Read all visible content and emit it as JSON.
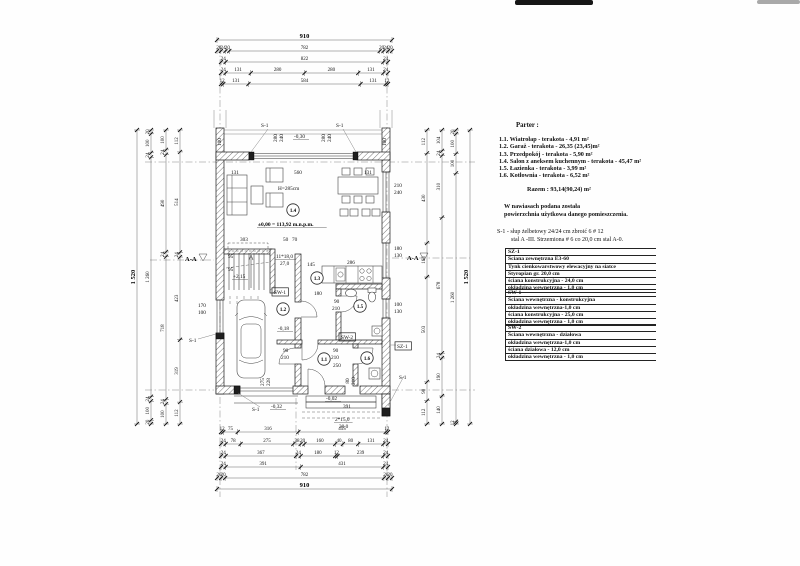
{
  "legend": {
    "title": "Parter :",
    "rooms": [
      "1.1.  Wiatrołap - terakota - 4,91 m²",
      "1.2.  Garaż - terakota - 26,35 (23,45)m²",
      "1.3.  Przedpokój - terakota - 5,90 m²",
      "1.4.  Salon z aneksem kuchennym - terakota - 45,47 m²",
      "1.5.  Łazienka - terakota - 3,99 m²",
      "1.6.  Kotłownia - terakota - 6,52 m²"
    ],
    "total": "Razem : 93,14(90,24)  m²",
    "note1": "W nawiasach podana została",
    "note2": "powierzchnia użytkowa danego pomieszczenia.",
    "s1_note1": "S-1 -  słup żelbetowy 24/24 cm zbroić 6 # 12",
    "s1_note2": "stal A -III. Strzemiona # 6 co 20,0 cm stal A-0.",
    "sz1": {
      "rows": [
        "SZ-1",
        "Ściana zewnętrzna E3-60",
        "Tynk cienkowarstwowy elewacyjny na siatce",
        "Styropian gr. 20,0 cm",
        "ściana konstrukcyjna - 24,0 cm",
        "okładzina wewnętrzna - 1,0 cm"
      ]
    },
    "sw1": {
      "rows": [
        "SW-1",
        "Ściana wewnętrzna - konstrukcyjna",
        "okładzina wewnętrzna-1,0 cm",
        "ściana konstrukcyjna - 25,0 cm",
        "okładzina wewnętrzna - 1,0 cm"
      ]
    },
    "sw2": {
      "rows": [
        "SW-2",
        "Ściana wewnętrzna - działowa",
        "okładzina wewnętrzna-1,0 cm",
        "ściana działowa - 12,0 cm",
        "okładzina wewnętrzna - 1,0 cm"
      ]
    }
  },
  "rooms": [
    {
      "id": "1.1",
      "x": 324,
      "y": 359
    },
    {
      "id": "1.2",
      "x": 283,
      "y": 309
    },
    {
      "id": "1.3",
      "x": 317,
      "y": 278
    },
    {
      "id": "1.4",
      "x": 293,
      "y": 210
    },
    {
      "id": "1.5",
      "x": 360,
      "y": 306
    },
    {
      "id": "1.6",
      "x": 367,
      "y": 358
    }
  ],
  "chains": [
    {
      "dir": "h",
      "y": 40,
      "x0": 217,
      "x1": 392,
      "v": [
        "910"
      ],
      "big": true
    },
    {
      "dir": "h",
      "y": 51,
      "x0": 217,
      "x1": 392,
      "v": [
        20,
        24,
        20,
        782,
        20,
        24,
        20
      ]
    },
    {
      "dir": "h",
      "y": 62,
      "x0": 221,
      "x1": 388,
      "v": [
        24,
        822,
        24
      ]
    },
    {
      "dir": "h",
      "y": 73,
      "x0": 221,
      "x1": 388,
      "v": [
        24,
        131,
        280,
        280,
        131,
        24
      ]
    },
    {
      "dir": "h",
      "y": 84,
      "x0": 221,
      "x1": 388,
      "v": [
        12,
        131,
        584,
        131,
        12
      ]
    },
    {
      "dir": "h",
      "y": 432,
      "x0": 221,
      "x1": 388,
      "v": [
        12,
        75,
        316,
        455,
        12
      ]
    },
    {
      "dir": "h",
      "y": 444,
      "x0": 221,
      "x1": 388,
      "v": [
        24,
        78,
        275,
        38,
        20,
        160,
        40,
        80,
        131,
        24
      ]
    },
    {
      "dir": "h",
      "y": 456,
      "x0": 221,
      "x1": 388,
      "v": [
        24,
        367,
        24,
        180,
        12,
        239,
        24
      ]
    },
    {
      "dir": "h",
      "y": 467,
      "x0": 221,
      "x1": 388,
      "v": [
        24,
        391,
        431,
        24
      ]
    },
    {
      "dir": "h",
      "y": 478,
      "x0": 217,
      "x1": 392,
      "v": [
        20,
        20,
        782,
        20,
        20
      ]
    },
    {
      "dir": "h",
      "y": 489,
      "x0": 217,
      "x1": 392,
      "v": [
        "910"
      ],
      "big": true
    },
    {
      "dir": "v",
      "x": 137,
      "y0": 130,
      "y1": 424,
      "v": [
        "1 520"
      ],
      "big": true
    },
    {
      "dir": "v",
      "x": 151,
      "y0": 130,
      "y1": 424,
      "v": [
        20,
        100,
        24,
        "1 260",
        24,
        100,
        20
      ]
    },
    {
      "dir": "v",
      "x": 166,
      "y0": 130,
      "y1": 424,
      "v": [
        100,
        24,
        490,
        24,
        718,
        24,
        100
      ]
    },
    {
      "dir": "v",
      "x": 180,
      "y0": 130,
      "y1": 424,
      "v": [
        112,
        514,
        24,
        423,
        319,
        112
      ]
    },
    {
      "dir": "v",
      "x": 427,
      "y0": 130,
      "y1": 424,
      "v": [
        112,
        430,
        163,
        503,
        90,
        112
      ]
    },
    {
      "dir": "v",
      "x": 442,
      "y0": 130,
      "y1": 424,
      "v": [
        104,
        24,
        310,
        678,
        24,
        190,
        140
      ]
    },
    {
      "dir": "v",
      "x": 456,
      "y0": 130,
      "y1": 424,
      "v": [
        20,
        100,
        100,
        "1 260",
        12
      ]
    },
    {
      "dir": "v",
      "x": 470,
      "y0": 130,
      "y1": 424,
      "v": [
        "1 520"
      ],
      "big": true
    }
  ],
  "labels": [
    {
      "t": "-0,30",
      "x": 294,
      "y": 138,
      "u": 1
    },
    {
      "t": "280",
      "x": 277,
      "y": 138,
      "r": 1
    },
    {
      "t": "240",
      "x": 283,
      "y": 138,
      "r": 1
    },
    {
      "t": "280",
      "x": 325,
      "y": 138,
      "r": 1
    },
    {
      "t": "240",
      "x": 331,
      "y": 138,
      "r": 1
    },
    {
      "t": "100",
      "x": 221,
      "y": 142,
      "r": 1
    },
    {
      "t": "100",
      "x": 386,
      "y": 142,
      "r": 1
    },
    {
      "t": "S-1",
      "x": 261,
      "y": 127
    },
    {
      "t": "S-1",
      "x": 336,
      "y": 127
    },
    {
      "t": "131",
      "x": 231,
      "y": 174
    },
    {
      "t": "560",
      "x": 294,
      "y": 174
    },
    {
      "t": "131",
      "x": 364,
      "y": 174
    },
    {
      "t": "H=285cm",
      "x": 278,
      "y": 190
    },
    {
      "t": "±0,00 = 113,92 m.n.p.m.",
      "x": 258,
      "y": 226,
      "b": 1,
      "u": 1
    },
    {
      "t": "210",
      "x": 394,
      "y": 187
    },
    {
      "t": "240",
      "x": 394,
      "y": 194
    },
    {
      "t": "180",
      "x": 394,
      "y": 250
    },
    {
      "t": "130",
      "x": 394,
      "y": 257
    },
    {
      "t": "100",
      "x": 394,
      "y": 306
    },
    {
      "t": "130",
      "x": 394,
      "y": 313
    },
    {
      "t": "170",
      "x": 198,
      "y": 307
    },
    {
      "t": "100",
      "x": 198,
      "y": 314
    },
    {
      "t": "303",
      "x": 240,
      "y": 241
    },
    {
      "t": "50",
      "x": 283,
      "y": 241
    },
    {
      "t": "70",
      "x": 292,
      "y": 241
    },
    {
      "t": "95",
      "x": 228,
      "y": 258
    },
    {
      "t": "95",
      "x": 228,
      "y": 271
    },
    {
      "t": "+2,15",
      "x": 233,
      "y": 278,
      "u": 1
    },
    {
      "t": "11*18,0",
      "x": 276,
      "y": 258,
      "u": 1
    },
    {
      "t": "27,0",
      "x": 280,
      "y": 265
    },
    {
      "t": "145",
      "x": 307,
      "y": 266
    },
    {
      "t": "286",
      "x": 347,
      "y": 264
    },
    {
      "t": "180",
      "x": 314,
      "y": 295
    },
    {
      "t": "90",
      "x": 334,
      "y": 303
    },
    {
      "t": "210",
      "x": 332,
      "y": 310
    },
    {
      "t": "-0,18",
      "x": 278,
      "y": 330,
      "u": 1
    },
    {
      "t": "SW-1",
      "x": 274,
      "y": 294,
      "box": 1
    },
    {
      "t": "SW-2",
      "x": 341,
      "y": 339,
      "box": 1
    },
    {
      "t": "SZ-1",
      "x": 397,
      "y": 348,
      "box": 1
    },
    {
      "t": "90",
      "x": 283,
      "y": 352
    },
    {
      "t": "210",
      "x": 281,
      "y": 359
    },
    {
      "t": "90",
      "x": 333,
      "y": 352
    },
    {
      "t": "210",
      "x": 331,
      "y": 359
    },
    {
      "t": "250",
      "x": 333,
      "y": 367
    },
    {
      "t": "80",
      "x": 349,
      "y": 381,
      "r": 1
    },
    {
      "t": "210",
      "x": 355,
      "y": 381,
      "r": 1
    },
    {
      "t": "275",
      "x": 264,
      "y": 382,
      "r": 1
    },
    {
      "t": "228",
      "x": 270,
      "y": 382,
      "r": 1
    },
    {
      "t": "-0,02",
      "x": 326,
      "y": 400,
      "u": 1
    },
    {
      "t": "391",
      "x": 343,
      "y": 408
    },
    {
      "t": "2*15,0",
      "x": 335,
      "y": 421,
      "u": 1
    },
    {
      "t": "30,0",
      "x": 339,
      "y": 428
    },
    {
      "t": "-0,32",
      "x": 271,
      "y": 408,
      "u": 1
    },
    {
      "t": "S-1",
      "x": 252,
      "y": 411
    },
    {
      "t": "S-1",
      "x": 189,
      "y": 342
    },
    {
      "t": "S-1",
      "x": 399,
      "y": 379
    },
    {
      "t": "A-A",
      "x": 185,
      "y": 261,
      "b": 1,
      "s": 7
    },
    {
      "t": "A-A",
      "x": 407,
      "y": 260,
      "b": 1,
      "s": 7
    }
  ]
}
